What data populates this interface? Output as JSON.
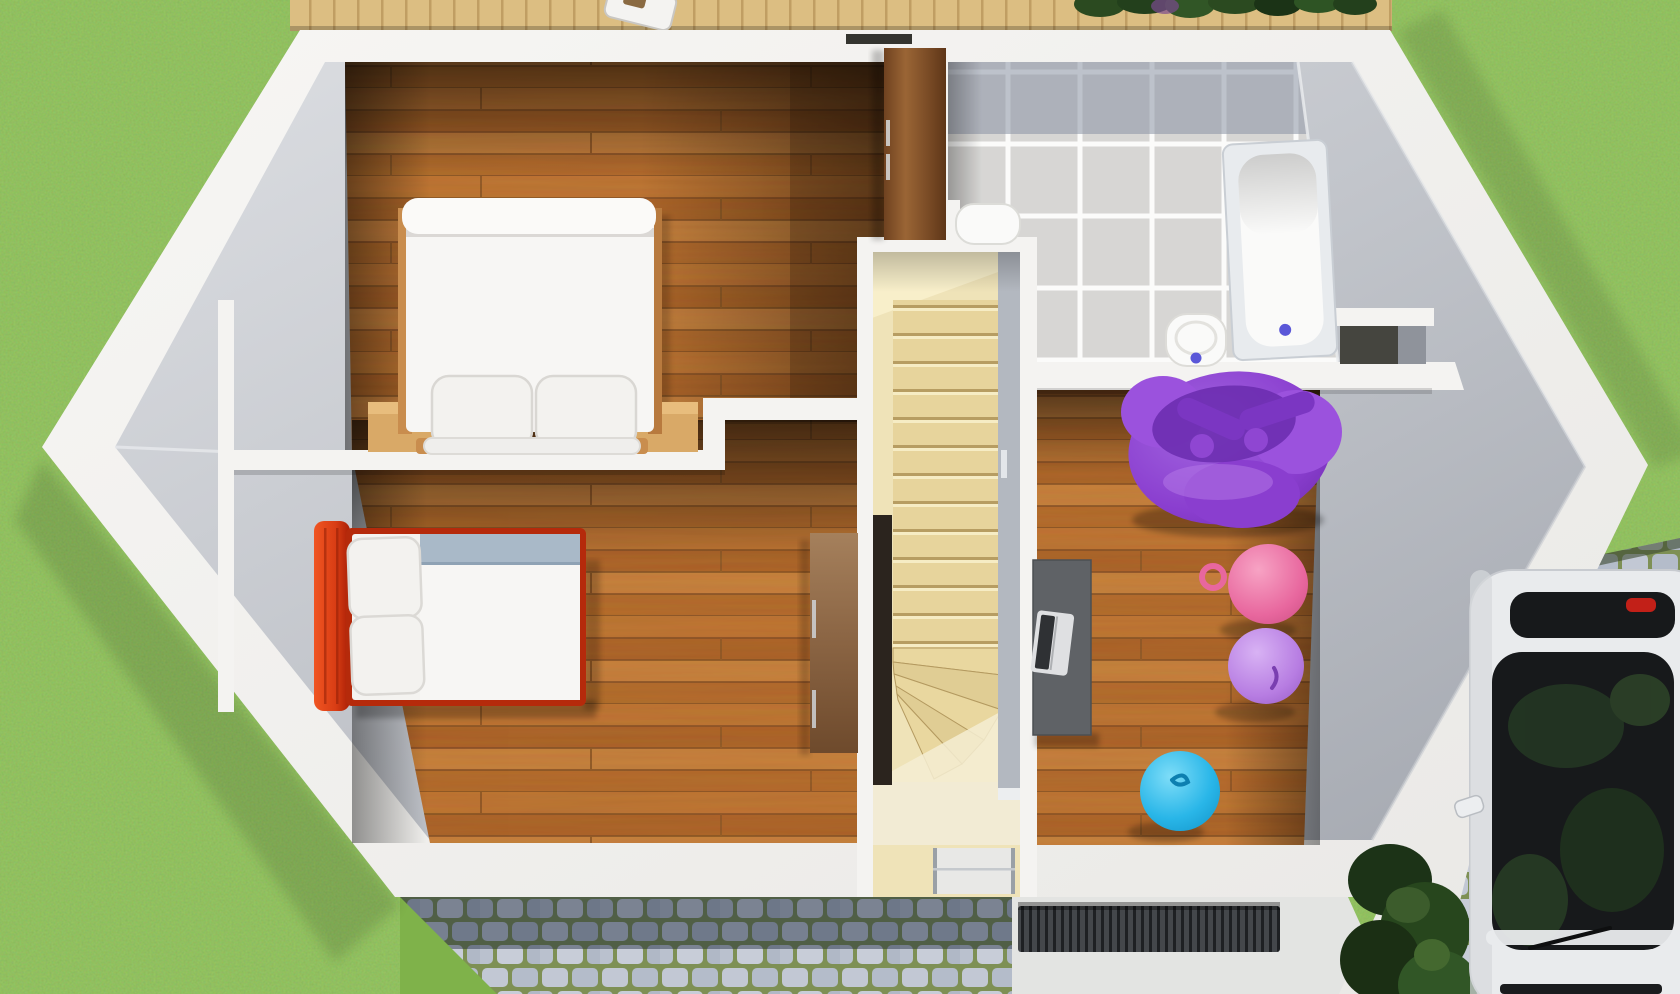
{
  "meta": {
    "kind": "3d-floorplan-render",
    "view": "top-down dollhouse view of upper storey",
    "canvas": {
      "width": 1680,
      "height": 994
    }
  },
  "palette": {
    "grass": "#86ba4f",
    "wall_cap": "#f4f3f1",
    "wall_band": "#f2f1ef",
    "wall_face_light": "#d9dbdf",
    "wall_face_dark": "#a7abb3",
    "wood_floor": "#b96a28",
    "wood_seam": "#7c451a",
    "stair_floor": "#efe3b8",
    "stair_tread": "#e7d49c",
    "entry_floor": "#f2ebd4",
    "stair_void": "#2b241e",
    "glass_rail": "#b3b8c0",
    "tile": "#d7d6d4",
    "tile_grout": "#fbfbfa",
    "tile_shadow": "#8b93a4",
    "fixture_white": "#fafaf9",
    "tub_rim": "#e8ebee",
    "drain_blue": "#5a57d8",
    "bed_linen": "#f7f6f4",
    "pillow": "#f3f2ef",
    "duvet_band": "#a9b9c8",
    "single_bed_frame": "#b52a0b",
    "headboard_red": "#e04d1c",
    "nightstand": "#d9a967",
    "wardrobe_dark": "#8a5a32",
    "wardrobe_light": "#8f6840",
    "beanbag_purple": "#8a3ecf",
    "ball_pink": "#e8679e",
    "ball_violet": "#b77de2",
    "ball_blue": "#29b6e8",
    "desk_grey": "#5f6266",
    "laptop_silver": "#dfe0e2",
    "deck_wood": "#dcbe82",
    "hedge_green": "#2b4a20",
    "cobble_stone": "#c2c8d4",
    "cobble_moss": "#7e9055",
    "porch_concrete": "#e3e4e2",
    "doormat": "#3a3d41",
    "door_glass": "#e8e8e6",
    "niche_dark": "#45453f",
    "car_body": "#e9ebed",
    "car_glass": "#17191b",
    "taillight_red": "#c22018",
    "shrub_green": "#1c3317"
  },
  "scene": {
    "ground": {
      "lawn": "grass lawn surrounding house",
      "deck": "wooden deck strip along top edge with small white table",
      "hedge": "dark hedge row at top right",
      "path": "cobblestone path below house, shaded near wall",
      "porch": "entrance porch with ribbed doormat",
      "driveway": "cobblestone driveway bottom right"
    },
    "house": {
      "shape": "elongated hexagon, white wall caps, grey inner wall faces",
      "rooms": [
        {
          "name": "bedroom-double",
          "position": "top-left",
          "floor": "orange wood planks",
          "furniture": [
            "double bed, white duvet, rolled edge",
            "two white pillows",
            "white foot rail with wood tips",
            "two light-wood nightstands",
            "tall dark wardrobe on right wall"
          ]
        },
        {
          "name": "bedroom-single",
          "position": "bottom-left",
          "floor": "orange wood planks",
          "furniture": [
            "single bed with red frame and red headboard",
            "two stacked white pillows",
            "white duvet with blue-grey fold",
            "brown wardrobe on right wall"
          ]
        },
        {
          "name": "bathroom",
          "position": "top-right",
          "floor": "grey tiles with white grout",
          "furniture": [
            "bathtub with blue drain",
            "toilet with blue flush",
            "wash basin",
            "dark storage niche"
          ]
        },
        {
          "name": "stair-hall",
          "position": "center",
          "floor": "pale wood",
          "furniture": [
            "straight flight of treads",
            "winder steps turning at bottom",
            "stair void",
            "glass rail panel",
            "front door with glass"
          ]
        },
        {
          "name": "playroom",
          "position": "right",
          "floor": "orange wood planks",
          "furniture": [
            "purple bean bag",
            "pink ball with handle ring",
            "violet ball",
            "blue ball",
            "dark grey desk with laptop"
          ]
        }
      ]
    },
    "exterior": {
      "car": "white car with black panoramic glass and red taillight, parked on driveway",
      "shrubs": "dark shrubs between house wall and car"
    }
  }
}
